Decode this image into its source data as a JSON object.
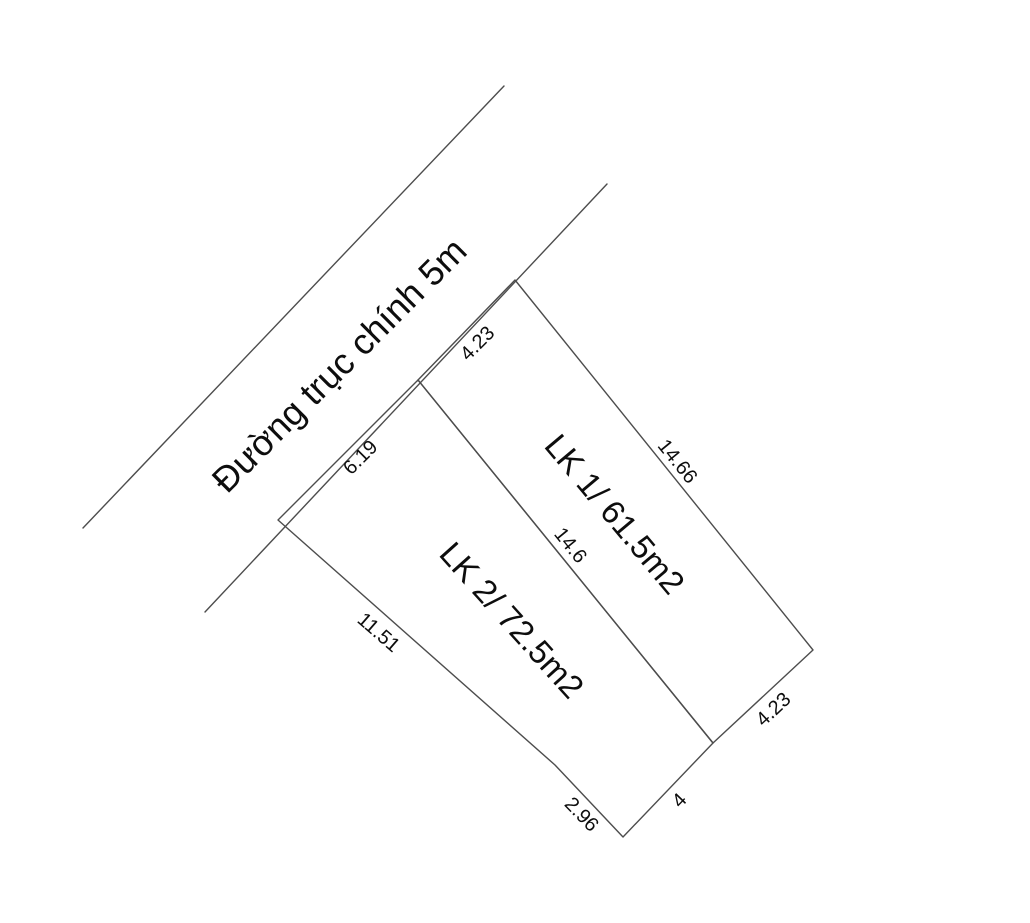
{
  "diagram": {
    "canvas": {
      "width": 1030,
      "height": 923,
      "background": "#ffffff",
      "line_color": "#4d4d4d",
      "text_color": "#0d0d0d",
      "line_width": 1.4
    },
    "road": {
      "label": "Đường trục chính 5m",
      "width_note": "5m",
      "label_x": 339,
      "label_y": 365,
      "label_rotation": -45,
      "label_font_size": 36,
      "edges": [
        {
          "name": "road-upper-edge",
          "x1": 83,
          "y1": 528,
          "x2": 504,
          "y2": 86
        },
        {
          "name": "road-frontage-edge",
          "x1": 205,
          "y1": 612,
          "x2": 607,
          "y2": 184
        }
      ]
    },
    "parcels": [
      {
        "id": "lk1",
        "label": "LK 1/ 61.5m2",
        "plot_name": "LK 1",
        "area": "61.5m2",
        "label_x": 615,
        "label_y": 514,
        "label_rotation": 50,
        "label_font_size": 33,
        "points": [
          [
            418,
            380
          ],
          [
            515,
            280
          ],
          [
            813,
            650
          ],
          [
            713,
            743
          ]
        ]
      },
      {
        "id": "lk2",
        "label": "LK 2/ 72.5m2",
        "plot_name": "LK 2",
        "area": "72.5m2",
        "label_x": 512,
        "label_y": 620,
        "label_rotation": 48,
        "label_font_size": 33,
        "points": [
          [
            278,
            520
          ],
          [
            418,
            380
          ],
          [
            713,
            743
          ],
          [
            623,
            837
          ],
          [
            555,
            765
          ]
        ]
      }
    ],
    "dimension_font_size": 20,
    "dimensions": [
      {
        "text": "4.23",
        "edge": "lk1-road-frontage",
        "x": 477,
        "y": 343,
        "rotation": -45
      },
      {
        "text": "6.19",
        "edge": "lk2-road-frontage",
        "x": 360,
        "y": 457,
        "rotation": -45
      },
      {
        "text": "14.66",
        "edge": "lk1-northeast-side",
        "x": 678,
        "y": 461,
        "rotation": 51
      },
      {
        "text": "14.6",
        "edge": "lk1-lk2-shared-side",
        "x": 571,
        "y": 545,
        "rotation": 51
      },
      {
        "text": "11.51",
        "edge": "lk2-southwest-side",
        "x": 379,
        "y": 632,
        "rotation": 41
      },
      {
        "text": "2.96",
        "edge": "lk2-bottom-left-side",
        "x": 582,
        "y": 814,
        "rotation": 46
      },
      {
        "text": "4",
        "edge": "lk2-bottom-side",
        "x": 679,
        "y": 800,
        "rotation": -46
      },
      {
        "text": "4.23",
        "edge": "lk1-southeast-side",
        "x": 773,
        "y": 709,
        "rotation": -43
      }
    ]
  }
}
